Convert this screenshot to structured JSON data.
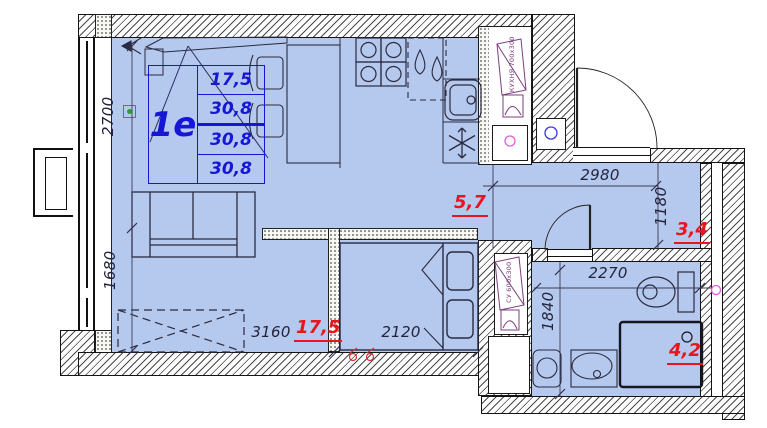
{
  "unit": {
    "label": "1е",
    "spec_values": [
      "17,5",
      "30,8",
      "30,8",
      "30,8"
    ]
  },
  "dimensions": {
    "living_width": "3160",
    "living_depth_upper": "2700",
    "living_depth_lower": "1680",
    "bed_width": "2120",
    "hall_width": "2980",
    "hall_depth": "1180",
    "bath_width": "2270",
    "bath_depth": "1840"
  },
  "areas": {
    "living": "17,5",
    "kitchen_zone": "5,7",
    "hall": "3,4",
    "bath": "4,2"
  },
  "vent_shafts": {
    "kitchen": "КУХНЯ 700х300",
    "bath": "СУ 600х300"
  },
  "colors": {
    "room_fill": "#b5c9ee",
    "plan_blue": "#1616d6",
    "area_red": "#e8151c",
    "vent_purple": "#7d3f7d",
    "marker_magenta": "#e05cd8",
    "marker_blue": "#3a3ad8",
    "marker_green": "#2f9e2f"
  }
}
